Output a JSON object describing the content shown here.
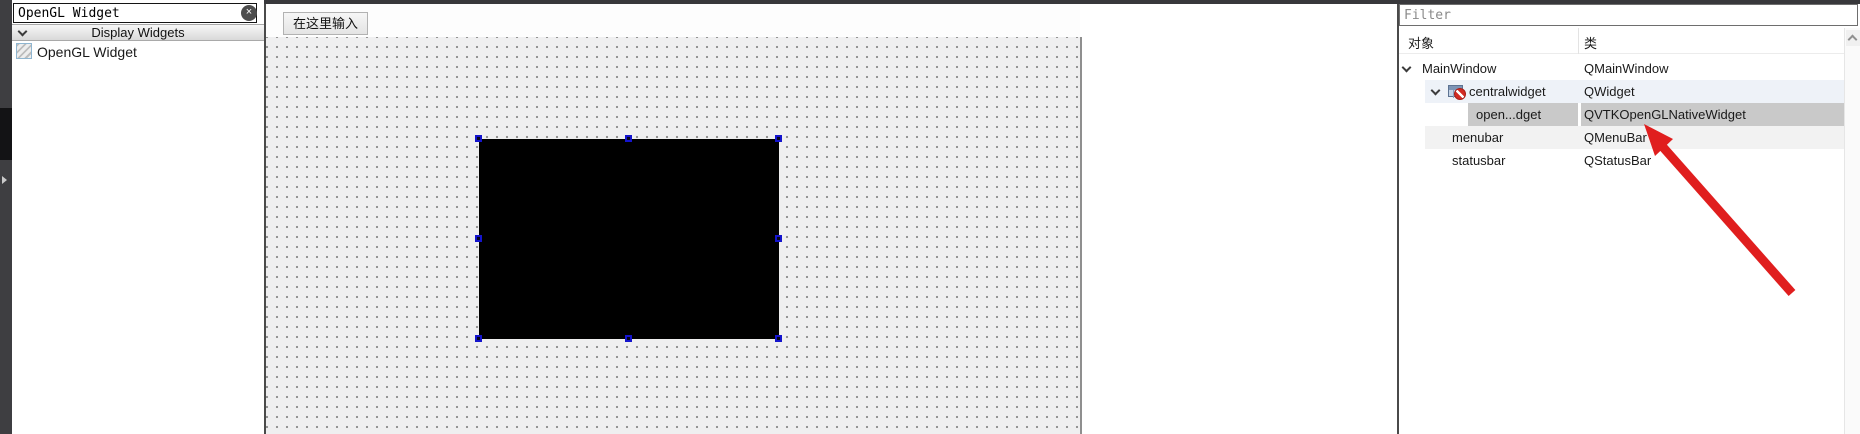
{
  "widget_box": {
    "search_value": "OpenGL Widget",
    "clear_icon": "×",
    "category": "Display Widgets",
    "item": "OpenGL Widget"
  },
  "form_editor": {
    "menu_placeholder": "在这里输入",
    "selected_widget": {
      "width": 300,
      "height": 200,
      "handle_color": "#1414cd"
    }
  },
  "object_inspector": {
    "filter_placeholder": "Filter",
    "columns": {
      "object": "对象",
      "class": "类"
    },
    "rows": [
      {
        "object": "MainWindow",
        "class": "QMainWindow",
        "selected": false
      },
      {
        "object": "centralwidget",
        "class": "QWidget",
        "selected": false
      },
      {
        "object": "open...dget",
        "class": "QVTKOpenGLNativeWidget",
        "selected": true
      },
      {
        "object": "menubar",
        "class": "QMenuBar",
        "selected": false
      },
      {
        "object": "statusbar",
        "class": "QStatusBar",
        "selected": false
      }
    ]
  },
  "annotation": {
    "arrow_color": "#e01e1e"
  },
  "colors": {
    "selection_gray": "#c9c9c9",
    "canvas": "#efeff0",
    "top_strip": "#38383b"
  }
}
